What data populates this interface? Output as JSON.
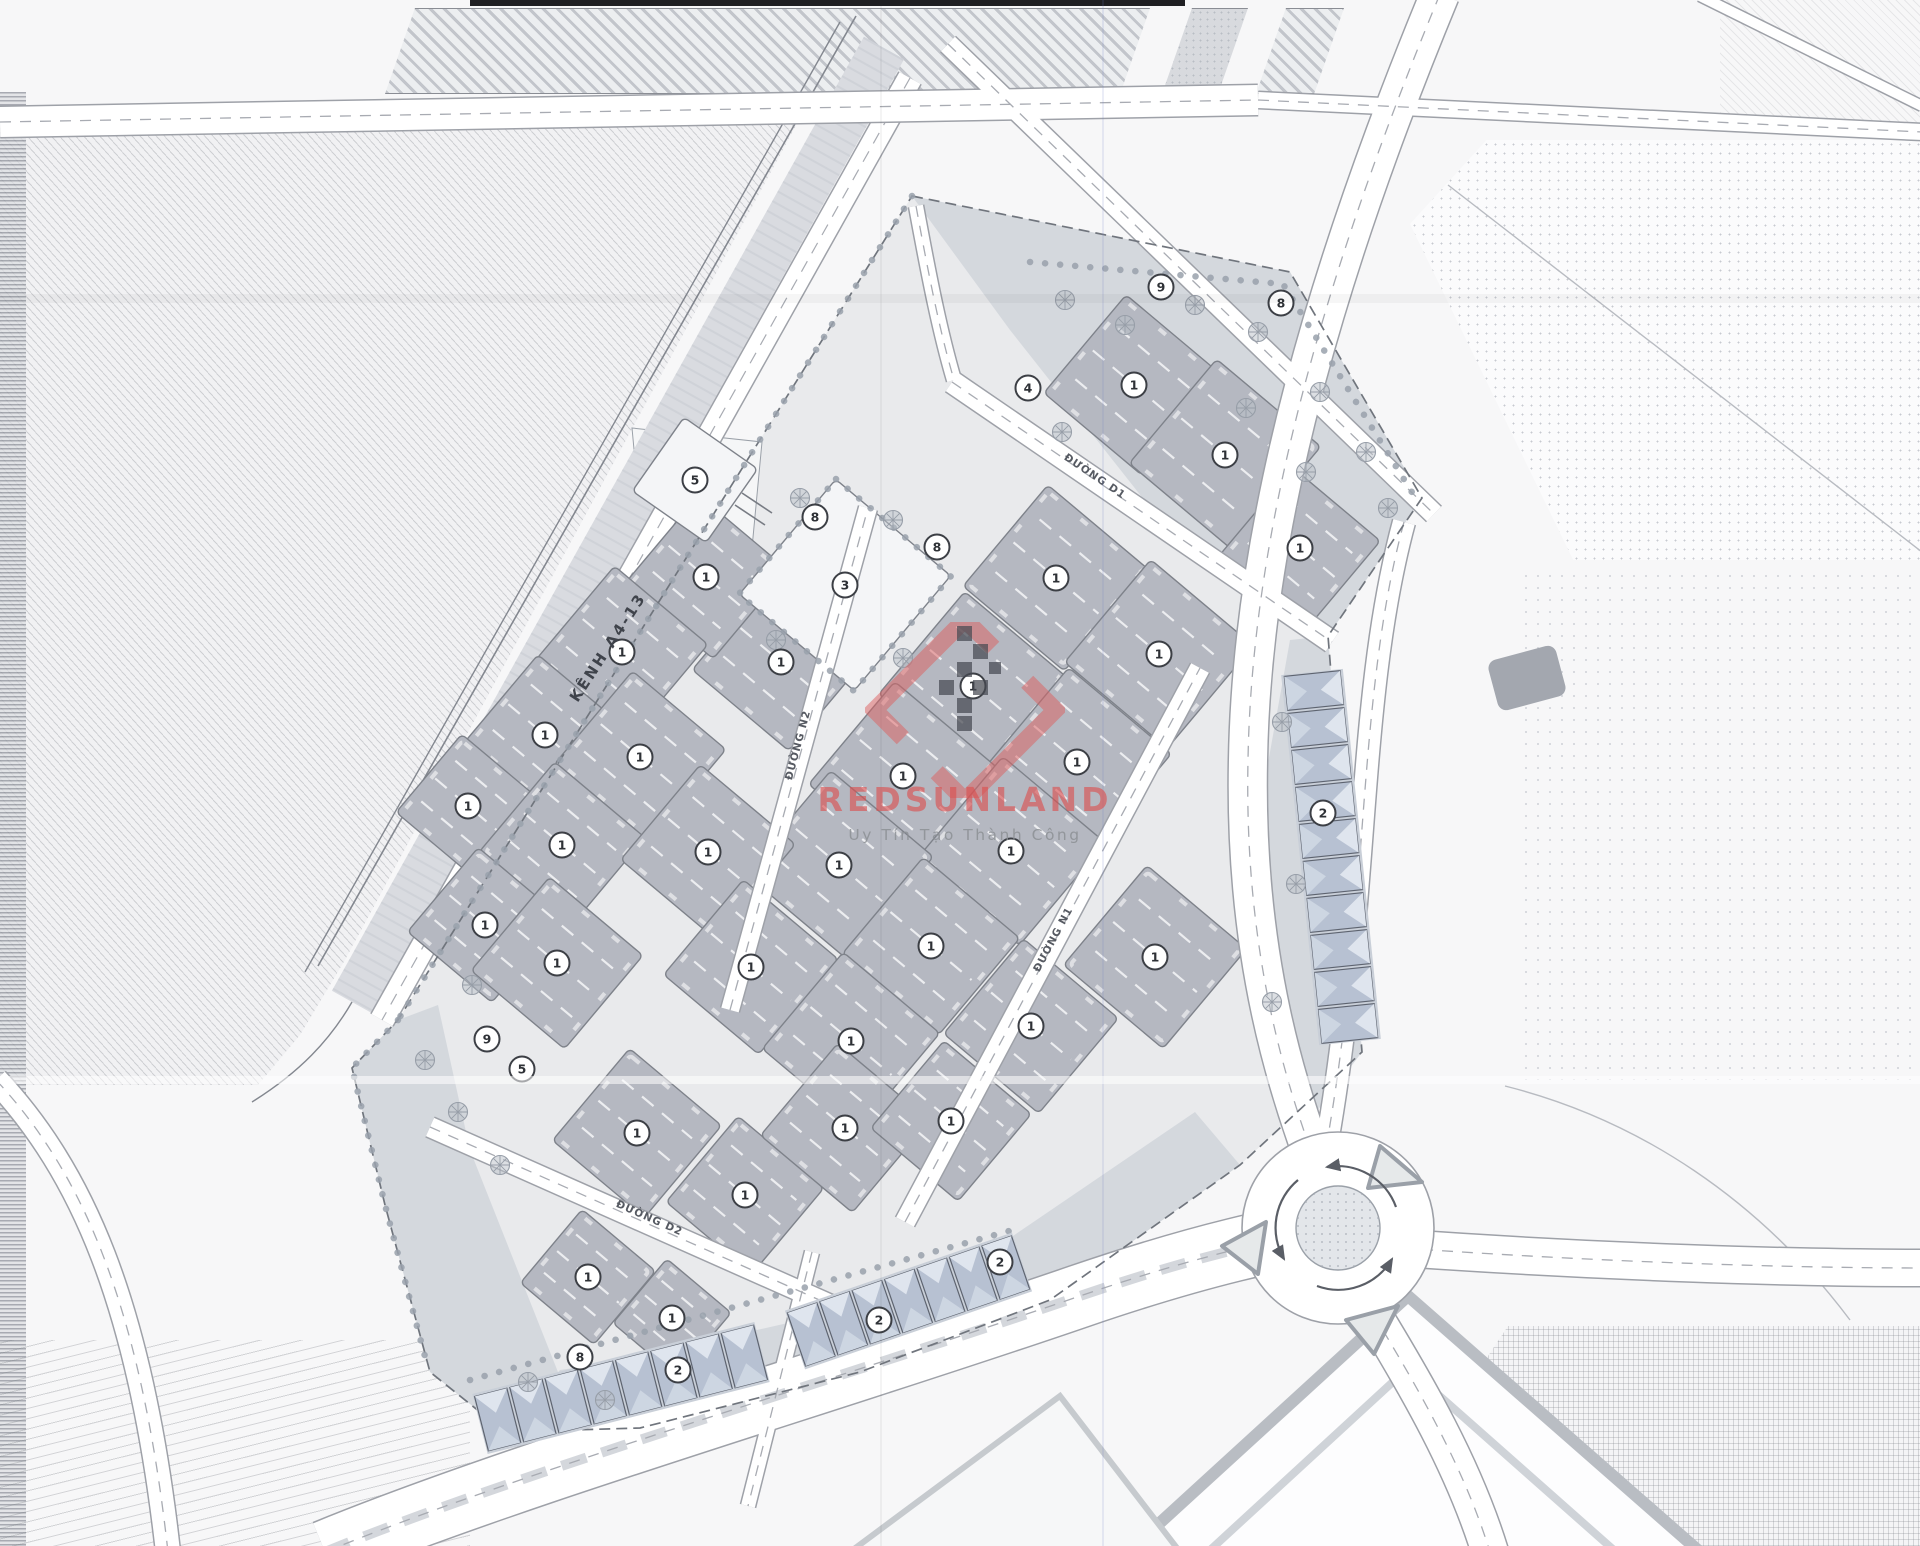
{
  "watermark": {
    "brand": "REDSUNLAND",
    "tagline": "Uy Tín Tạo Thành Công",
    "accent": "#d95c5c"
  },
  "labels": {
    "canal": {
      "text": "KÊNH A4-13",
      "x": 612,
      "y": 650,
      "rot": -57
    },
    "roads": [
      {
        "text": "ĐƯỜNG D1",
        "x": 1093,
        "y": 479,
        "rot": 34
      },
      {
        "text": "ĐƯỜNG D2",
        "x": 648,
        "y": 1221,
        "rot": 24
      },
      {
        "text": "ĐƯỜNG N1",
        "x": 1056,
        "y": 941,
        "rot": -62
      },
      {
        "text": "ĐƯỜNG N2",
        "x": 801,
        "y": 746,
        "rot": -75
      }
    ]
  },
  "colors": {
    "paper": "#f7f7f8",
    "site": "#e9eaec",
    "lot": "#b5b8c1",
    "lot_light": "#f4f5f7",
    "lot_stroke": "#7e828a",
    "buffer": "#d2d6db",
    "road": "#ffffff",
    "casing": "#9ea1a8",
    "dash": "#a8abb2",
    "unit": "#b7c1d2",
    "unit_roof": "#dfe5ee",
    "unit_roof2": "#cdd6e2",
    "ink": "#565a62",
    "circle_stroke": "#3c3f45"
  },
  "lots": [
    {
      "x": 1134,
      "y": 385,
      "s": 128,
      "n": "1"
    },
    {
      "x": 1225,
      "y": 455,
      "s": 136,
      "n": "1"
    },
    {
      "x": 1300,
      "y": 548,
      "s": 114,
      "n": "1"
    },
    {
      "x": 1056,
      "y": 578,
      "s": 132,
      "n": "1"
    },
    {
      "x": 973,
      "y": 686,
      "s": 134,
      "n": "1"
    },
    {
      "x": 1159,
      "y": 654,
      "s": 134,
      "n": "1"
    },
    {
      "x": 1077,
      "y": 762,
      "s": 134,
      "n": "1"
    },
    {
      "x": 903,
      "y": 776,
      "s": 134,
      "n": "1"
    },
    {
      "x": 1011,
      "y": 851,
      "s": 134,
      "n": "1"
    },
    {
      "x": 839,
      "y": 865,
      "s": 134,
      "n": "1"
    },
    {
      "x": 781,
      "y": 662,
      "s": 126,
      "n": "1"
    },
    {
      "x": 706,
      "y": 577,
      "s": 116,
      "n": "1"
    },
    {
      "x": 622,
      "y": 652,
      "s": 122,
      "n": "1"
    },
    {
      "x": 545,
      "y": 735,
      "s": 114,
      "n": "1"
    },
    {
      "x": 640,
      "y": 757,
      "s": 122,
      "n": "1"
    },
    {
      "x": 468,
      "y": 806,
      "s": 102,
      "n": "1"
    },
    {
      "x": 562,
      "y": 845,
      "s": 118,
      "n": "1"
    },
    {
      "x": 708,
      "y": 852,
      "s": 124,
      "n": "1"
    },
    {
      "x": 485,
      "y": 925,
      "s": 110,
      "n": "1"
    },
    {
      "x": 557,
      "y": 963,
      "s": 122,
      "n": "1"
    },
    {
      "x": 751,
      "y": 967,
      "s": 124,
      "n": "1"
    },
    {
      "x": 931,
      "y": 946,
      "s": 126,
      "n": "1"
    },
    {
      "x": 851,
      "y": 1041,
      "s": 126,
      "n": "1"
    },
    {
      "x": 1031,
      "y": 1026,
      "s": 124,
      "n": "1"
    },
    {
      "x": 1155,
      "y": 957,
      "s": 130,
      "n": "1"
    },
    {
      "x": 637,
      "y": 1133,
      "s": 120,
      "n": "1"
    },
    {
      "x": 745,
      "y": 1195,
      "s": 112,
      "n": "1"
    },
    {
      "x": 845,
      "y": 1128,
      "s": 120,
      "n": "1"
    },
    {
      "x": 951,
      "y": 1121,
      "s": 114,
      "n": "1"
    },
    {
      "x": 588,
      "y": 1277,
      "s": 96,
      "n": "1"
    },
    {
      "x": 672,
      "y": 1318,
      "s": 84,
      "n": "1"
    },
    {
      "x": 845,
      "y": 585,
      "s": 150,
      "n": "3",
      "light": true
    },
    {
      "x": 695,
      "y": 480,
      "s": 90,
      "n": "5",
      "light": true,
      "rot": 35
    }
  ],
  "markers": [
    {
      "n": "9",
      "x": 1161,
      "y": 287
    },
    {
      "n": "8",
      "x": 1281,
      "y": 303
    },
    {
      "n": "4",
      "x": 1028,
      "y": 388
    },
    {
      "n": "8",
      "x": 937,
      "y": 547
    },
    {
      "n": "8",
      "x": 815,
      "y": 517
    },
    {
      "n": "9",
      "x": 487,
      "y": 1039
    },
    {
      "n": "5",
      "x": 522,
      "y": 1069
    },
    {
      "n": "8",
      "x": 580,
      "y": 1357
    },
    {
      "n": "2",
      "x": 678,
      "y": 1370
    },
    {
      "n": "2",
      "x": 879,
      "y": 1320
    },
    {
      "n": "2",
      "x": 1000,
      "y": 1262
    },
    {
      "n": "2",
      "x": 1323,
      "y": 813
    }
  ],
  "strips": [
    {
      "x1": 480,
      "y1": 1424,
      "x2": 762,
      "y2": 1352,
      "units": 8
    },
    {
      "x1": 795,
      "y1": 1340,
      "x2": 1022,
      "y2": 1262,
      "units": 7
    },
    {
      "x1": 1312,
      "y1": 672,
      "x2": 1350,
      "y2": 1042,
      "units": 10
    }
  ],
  "trees": [
    [
      1065,
      300
    ],
    [
      1125,
      325
    ],
    [
      1195,
      305
    ],
    [
      1258,
      332
    ],
    [
      1320,
      392
    ],
    [
      1366,
      452
    ],
    [
      1388,
      508
    ],
    [
      1306,
      472
    ],
    [
      1246,
      408
    ],
    [
      1062,
      432
    ],
    [
      800,
      498
    ],
    [
      893,
      520
    ],
    [
      776,
      640
    ],
    [
      903,
      658
    ],
    [
      425,
      1060
    ],
    [
      458,
      1112
    ],
    [
      472,
      985
    ],
    [
      500,
      1165
    ],
    [
      528,
      1382
    ],
    [
      605,
      1400
    ],
    [
      1282,
      722
    ],
    [
      1296,
      884
    ],
    [
      1272,
      1002
    ]
  ]
}
